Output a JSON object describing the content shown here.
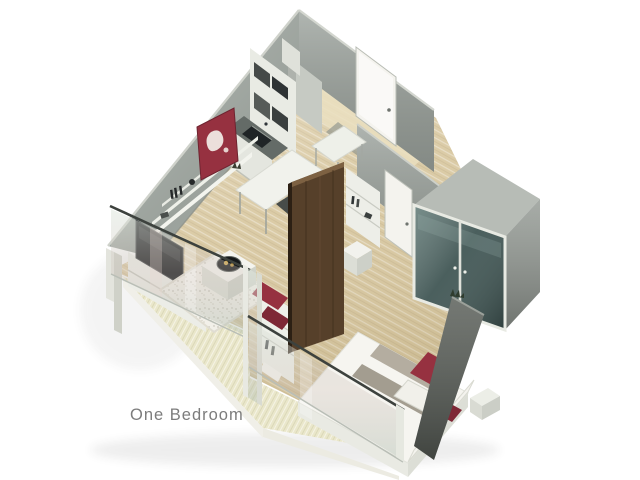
{
  "title": {
    "label": "One Bedroom",
    "color": "#7c7c7c"
  },
  "scene": {
    "background": "#ffffff",
    "description": "isometric 3D cutaway floor plan of a one-bedroom apartment",
    "rooms": [
      "living room",
      "kitchen",
      "entry hall",
      "bedroom",
      "balcony"
    ],
    "palette": {
      "wall_gray": "#99a09a",
      "wall_gray_2": "#9aa19b",
      "wall_top": "#cfd2cb",
      "floor_wood": "#d8c79f",
      "hall_wood": "#eadfc0",
      "deck_wood": "#eae7cb",
      "white_furniture": "#f0f0ea",
      "walnut_panel": "#56402a",
      "accent_red": "#963140",
      "accent_red_dark": "#7e2836",
      "tv_screen": "#1a1d1f",
      "railing": "#3d423e",
      "closet_glass": "#3f5553",
      "se_wall": "#565b55",
      "door_white": "#f4f3ee",
      "counter_dark": "#646b67",
      "sink_black": "#1f2426"
    },
    "furniture": [
      "kitchen cabinets",
      "refrigerator",
      "sink counter",
      "wall shelves",
      "red wall art",
      "tv",
      "media unit",
      "desk",
      "chair",
      "dining table",
      "shag rug",
      "coffee table with bowl",
      "bookshelf with red cushions",
      "walnut partition",
      "bed with red pillows",
      "ottoman",
      "bedside bench",
      "glass front wardrobe",
      "entrance door",
      "interior door",
      "glass balcony railing"
    ]
  }
}
